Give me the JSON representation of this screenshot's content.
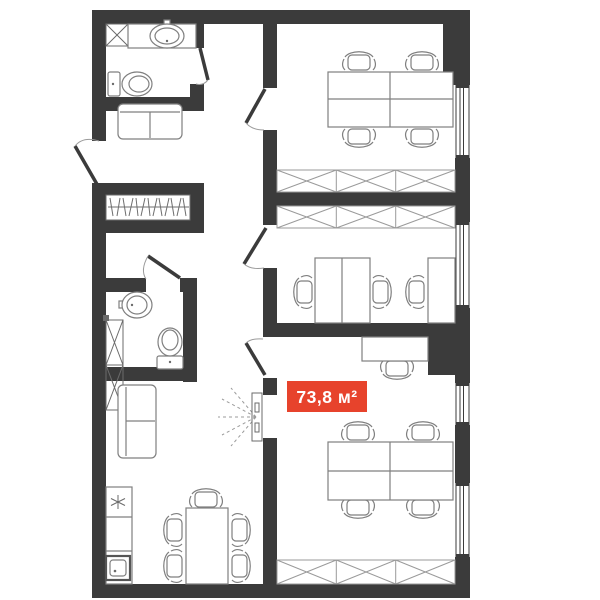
{
  "plan": {
    "area_label": "73,8 м²",
    "area_value": "73,8",
    "area_unit": "м²"
  },
  "colors": {
    "wall": "#3b3b3b",
    "furniture": "#7f7f7f",
    "furniture_dark": "#6b6b6b",
    "accent": "#e7432c",
    "label_text": "#ffffff",
    "background": "#ffffff"
  },
  "icons": {
    "stove": "six-ray-asterisk",
    "shelving": "x-braced-box",
    "wardrobe": "zigzag-hanger-rail",
    "window": "double-line-glazing",
    "door": "diagonal-leaf-with-arc",
    "sliding_door": "panel-with-dashed-fan"
  }
}
